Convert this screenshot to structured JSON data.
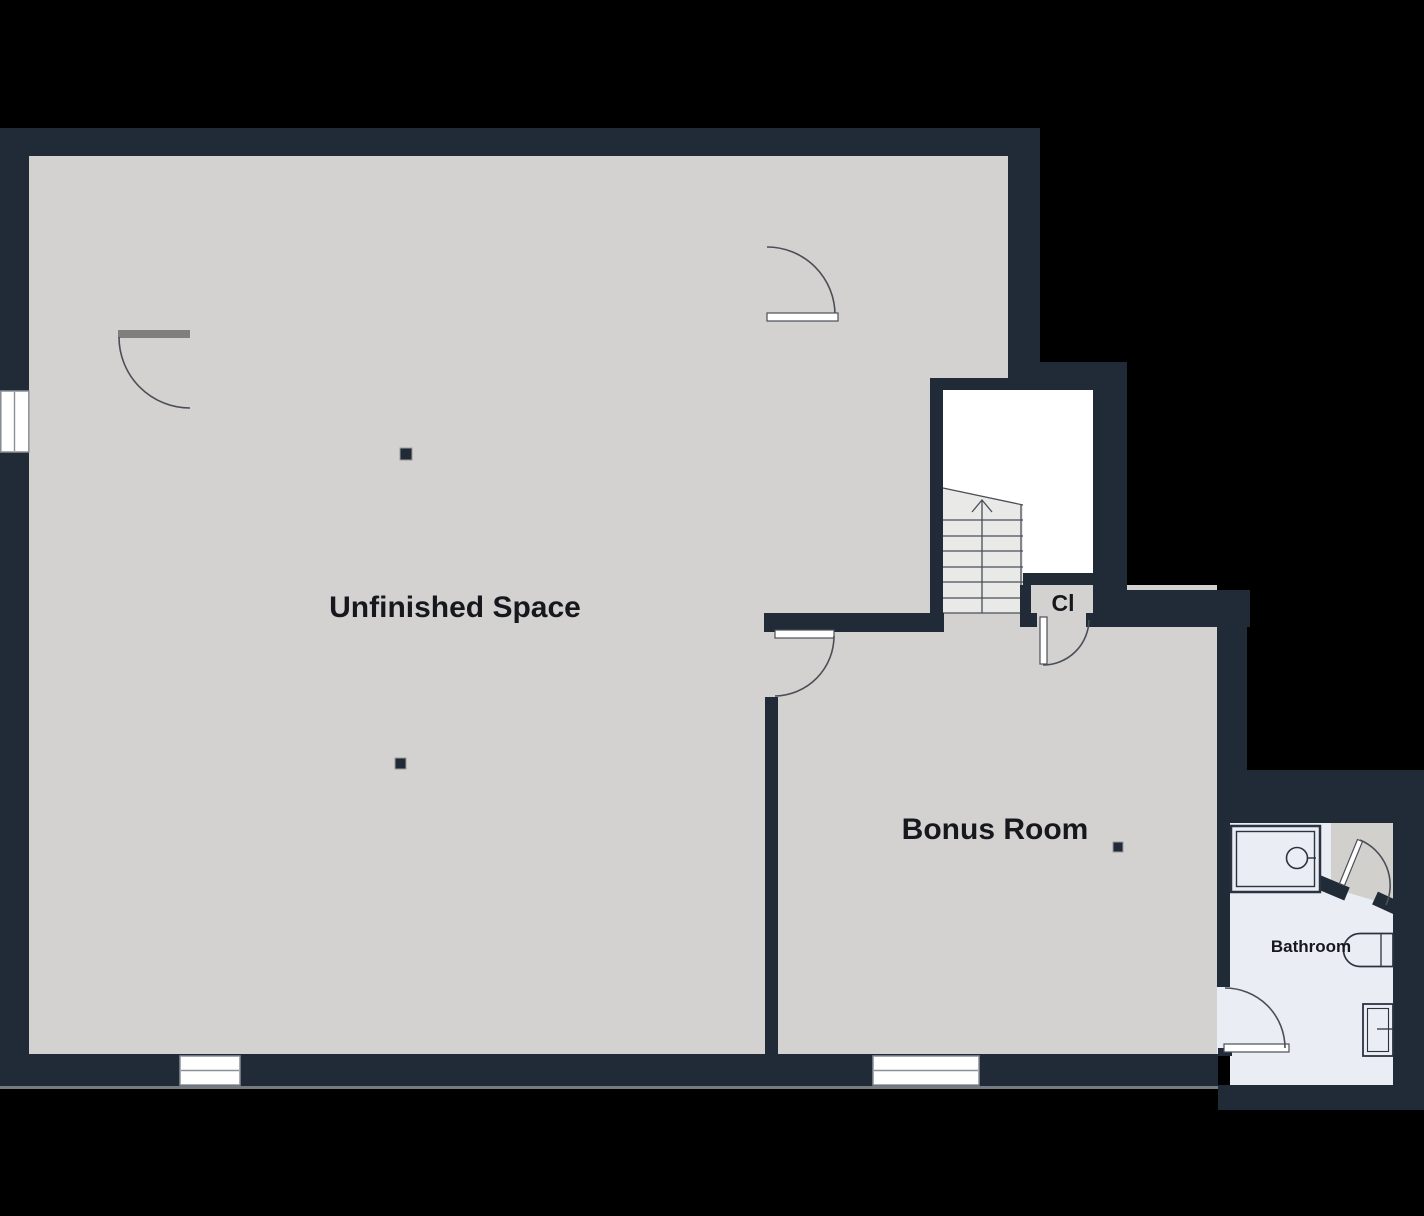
{
  "canvas": {
    "width": 1424,
    "height": 1216
  },
  "rooms": [
    {
      "id": "unfinished-space",
      "label": "Unfinished Space"
    },
    {
      "id": "bonus-room",
      "label": "Bonus Room"
    },
    {
      "id": "closet",
      "label": "Cl"
    },
    {
      "id": "bathroom",
      "label": "Bathroom"
    }
  ],
  "fixtures": [
    {
      "name": "staircase-up-icon"
    },
    {
      "name": "shower-icon"
    },
    {
      "name": "sink-vanity-icon"
    },
    {
      "name": "toilet-icon"
    }
  ],
  "colors": {
    "bg-color": "#000000",
    "wall-color": "#212b38",
    "floor-color": "#d3d2d0",
    "bathroom-floor-color": "#eaedf3",
    "hall-floor-color": "#d1d0cc",
    "stairwell-color": "#ffffff",
    "stair-tread-color": "#e9e9e8",
    "line-color": "#4a4f57",
    "fixture-line-color": "#2b3341",
    "window-frame-color": "#8a9097",
    "label-color": "#16181d",
    "door-leaf-gray": "#7f7f7f",
    "base-line-color": "#767b82"
  }
}
